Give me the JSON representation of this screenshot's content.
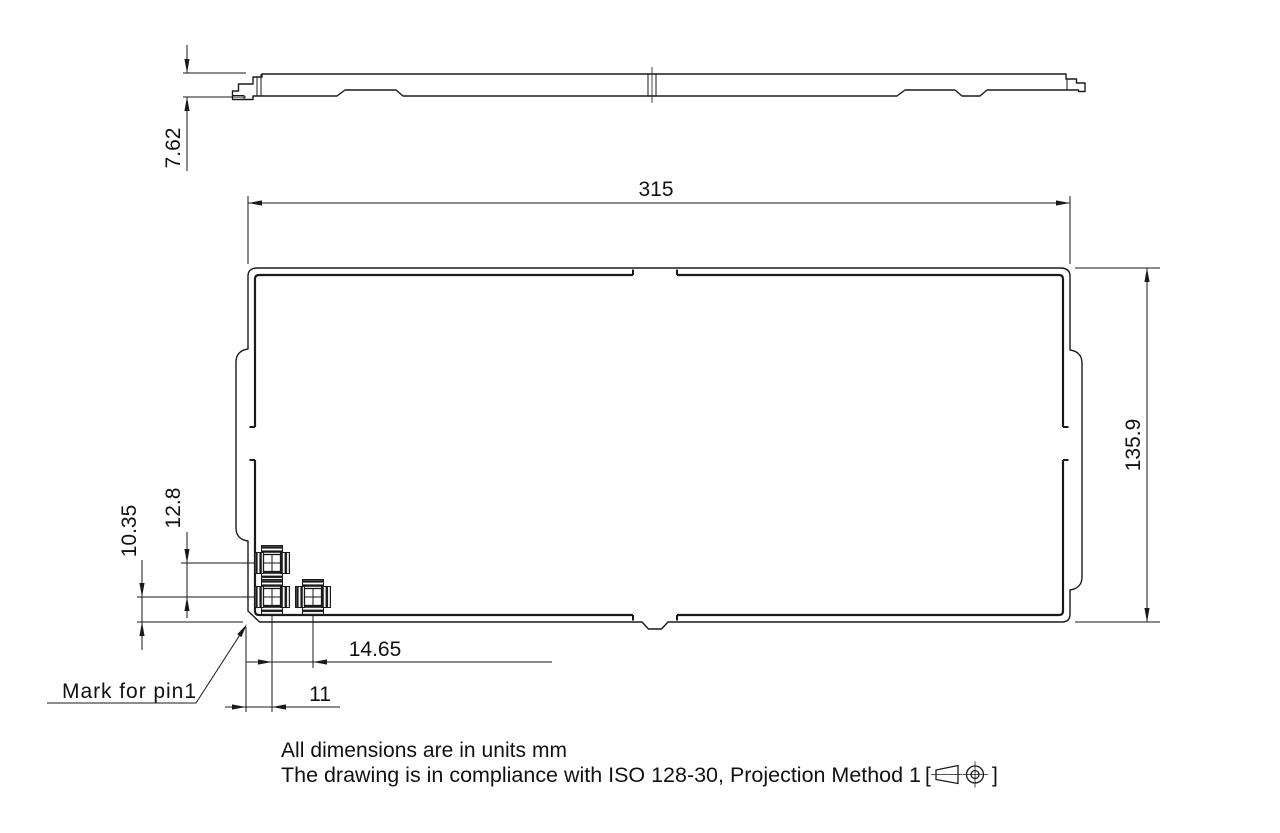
{
  "drawing": {
    "dimensions": {
      "profile_thickness": "7.62",
      "overall_width": "315",
      "overall_height": "135.9",
      "pin_vertical_pitch": "12.8",
      "pin_bottom_offset": "10.35",
      "pin_horizontal_pitch": "14.65",
      "pin_left_offset": "11"
    },
    "labels": {
      "pin1_mark": "Mark for pin1"
    },
    "notes": {
      "units": "All dimensions are in units mm",
      "compliance": "The drawing is in compliance with ISO 128-30, Projection Method 1",
      "bracket_open": "[",
      "bracket_close": "]"
    },
    "icons": {
      "projection_symbol": "first-angle-projection-icon"
    },
    "colors": {
      "line": "#1a1a1a",
      "background": "#ffffff"
    }
  }
}
